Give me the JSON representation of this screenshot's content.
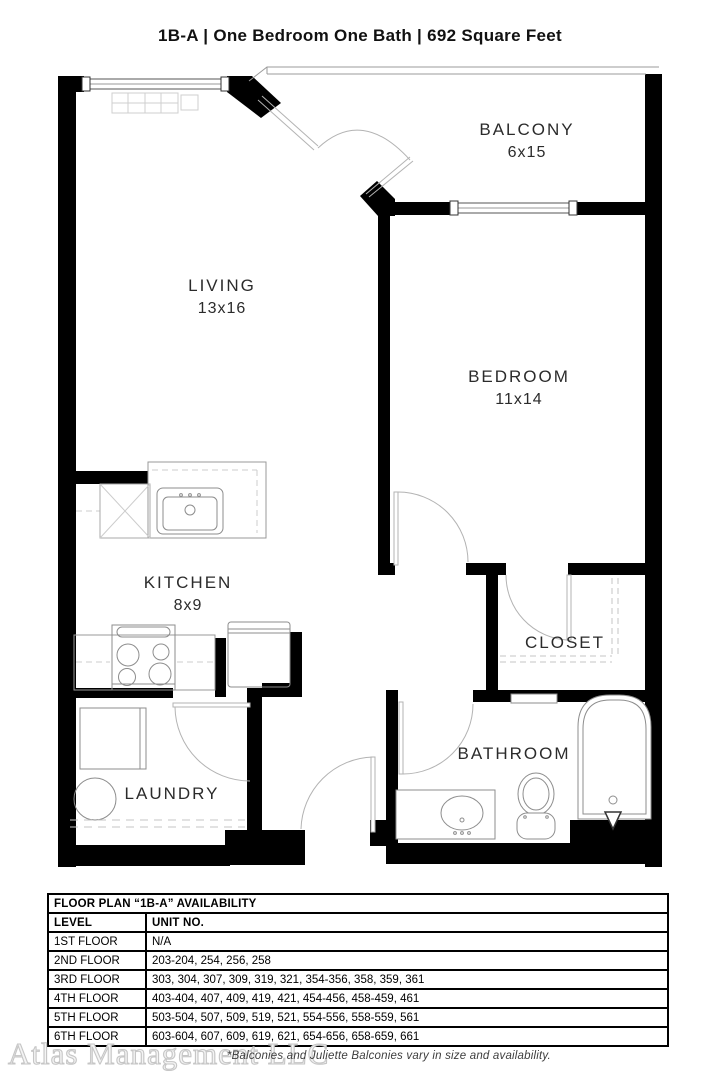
{
  "title": "1B-A  | One Bedroom One Bath |  692 Square Feet",
  "rooms": {
    "living": {
      "name": "LIVING",
      "dims": "13x16"
    },
    "balcony": {
      "name": "BALCONY",
      "dims": "6x15"
    },
    "bedroom": {
      "name": "BEDROOM",
      "dims": "11x14"
    },
    "kitchen": {
      "name": "KITCHEN",
      "dims": "8x9"
    },
    "closet": {
      "name": "CLOSET"
    },
    "bathroom": {
      "name": "BATHROOM"
    },
    "laundry": {
      "name": "LAUNDRY"
    }
  },
  "availability": {
    "title": "FLOOR PLAN “1B-A” AVAILABILITY",
    "columns": {
      "level": "LEVEL",
      "units": "UNIT NO."
    },
    "rows": [
      {
        "level": "1ST FLOOR",
        "units": "N/A"
      },
      {
        "level": "2ND FLOOR",
        "units": "203-204, 254, 256, 258"
      },
      {
        "level": "3RD FLOOR",
        "units": "303, 304, 307, 309, 319, 321, 354-356, 358, 359, 361"
      },
      {
        "level": "4TH FLOOR",
        "units": "403-404, 407, 409, 419, 421, 454-456, 458-459, 461"
      },
      {
        "level": "5TH FLOOR",
        "units": "503-504, 507, 509, 519, 521, 554-556, 558-559, 561"
      },
      {
        "level": "6TH FLOOR",
        "units": "603-604, 607, 609, 619, 621, 654-656, 658-659, 661"
      }
    ]
  },
  "footer": {
    "watermark": "Atlas Management LLC",
    "note": "*Balconies and Juliette Balconies vary in size and availability."
  },
  "colors": {
    "wall": "#000000",
    "fixture_line": "#9b9b9b",
    "door_line": "#b3b3b3"
  }
}
